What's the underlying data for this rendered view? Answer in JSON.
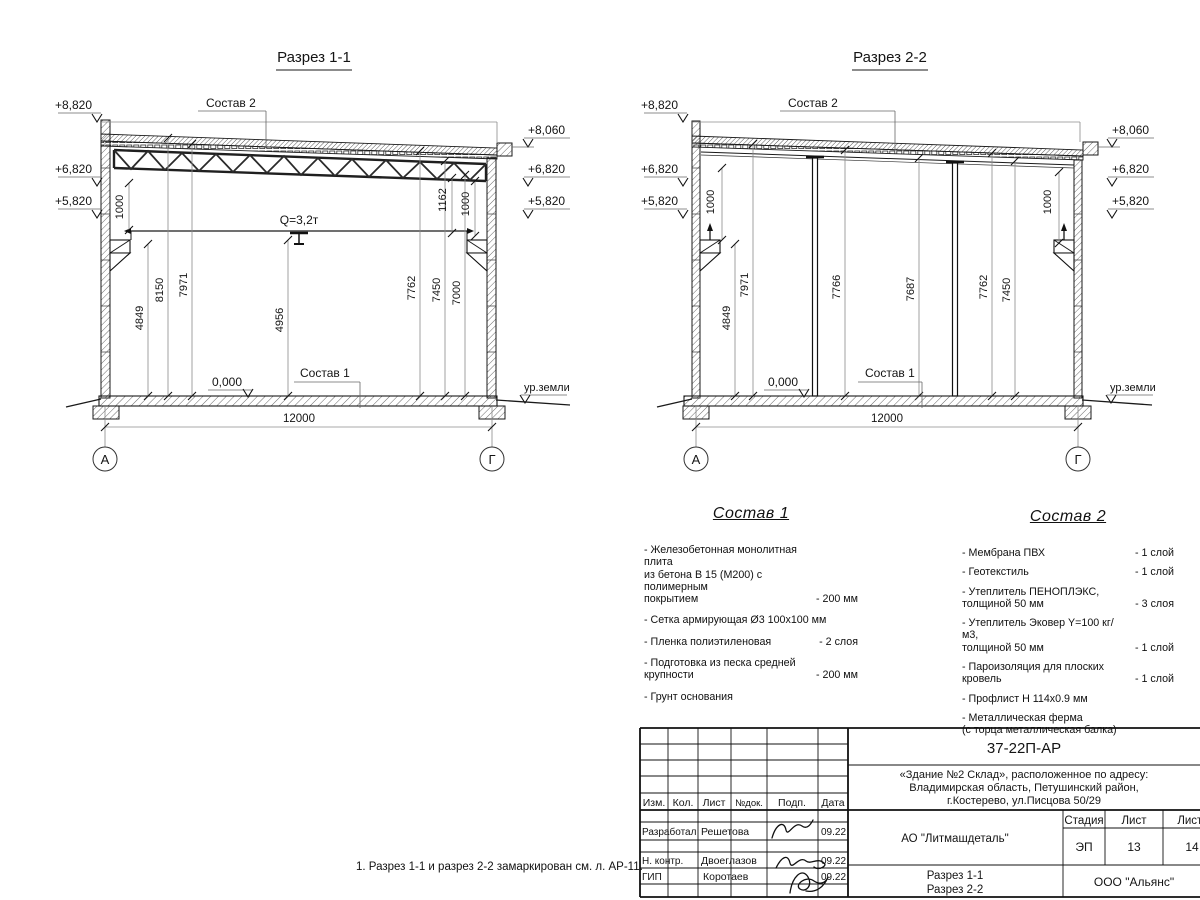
{
  "sheet": {
    "note": "1. Разрез 1-1 и разрез 2-2 замаркирован см. л. АР-11."
  },
  "s1": {
    "title": "Разрез 1-1",
    "e_l1": "+8,820",
    "e_l2": "+6,820",
    "e_l3": "+5,820",
    "e_r1": "+8,060",
    "e_r2": "+6,820",
    "e_r3": "+5,820",
    "roof_callout": "Состав 2",
    "floor_callout": "Состав 1",
    "crane": "Q=3,2т",
    "zero": "0,000",
    "ground": "ур.земли",
    "span": "12000",
    "axA": "А",
    "axG": "Г",
    "d1": "4849",
    "d2": "8150",
    "d3": "7971",
    "d4": "4956",
    "d5": "7762",
    "d6": "7450",
    "d7": "7000",
    "t1": "1000",
    "t2": "1162",
    "t3": "1000"
  },
  "s2": {
    "title": "Разрез 2-2",
    "e_l1": "+8,820",
    "e_l2": "+6,820",
    "e_l3": "+5,820",
    "e_r1": "+8,060",
    "e_r2": "+6,820",
    "e_r3": "+5,820",
    "roof_callout": "Состав 2",
    "floor_callout": "Состав 1",
    "zero": "0,000",
    "ground": "ур.земли",
    "span": "12000",
    "axA": "А",
    "axG": "Г",
    "d1": "4849",
    "d2": "7971",
    "d3": "7766",
    "d4": "7687",
    "d5": "7762",
    "d6": "7450",
    "t1": "1000",
    "t2": "1000"
  },
  "sostav1": {
    "title": "Состав 1",
    "items": [
      {
        "name": "- Железобетонная  монолитная плита\nиз бетона В 15 (М200) с полимерным\nпокрытием",
        "value": "- 200 мм"
      },
      {
        "name": "- Сетка армирующая Ø3 100х100 мм",
        "value": ""
      },
      {
        "name": "- Пленка полиэтиленовая",
        "value": "- 2 слоя"
      },
      {
        "name": "- Подготовка из песка средней\nкрупности",
        "value": "- 200 мм"
      },
      {
        "name": "- Грунт основания",
        "value": ""
      }
    ]
  },
  "sostav2": {
    "title": "Состав 2",
    "items": [
      {
        "name": "- Мембрана ПВХ",
        "value": "- 1 слой"
      },
      {
        "name": "- Геотекстиль",
        "value": "- 1 слой"
      },
      {
        "name": "- Утеплитель ПЕНОПЛЭКС,\nтолщиной 50 мм",
        "value": "- 3 слоя"
      },
      {
        "name": "- Утеплитель Эковер Y=100 кг/м3,\nтолщиной 50 мм",
        "value": "- 1 слой"
      },
      {
        "name": "- Пароизоляция для плоских кровель",
        "value": "- 1 слой"
      },
      {
        "name": "- Профлист Н 114х0.9 мм",
        "value": ""
      },
      {
        "name": "- Металлическая ферма\n(с торца металлическая балка)",
        "value": ""
      }
    ]
  },
  "tb": {
    "doc": "37-22П-АР",
    "addr1": "«Здание №2 Склад», расположенное по адресу:",
    "addr2": "Владимирская область, Петушинский район,",
    "addr3": "г.Костерево, ул.Писцова 50/29",
    "company": "АО \"Литмашдеталь\"",
    "h_stage": "Стадия",
    "h_sheet": "Лист",
    "h_sheets": "Листов",
    "stage": "ЭП",
    "sheet": "13",
    "sheets": "14",
    "content1": "Разрез 1-1",
    "content2": "Разрез 2-2",
    "org": "ООО \"Альянс\"",
    "c_izm": "Изм.",
    "c_kol": "Кол.",
    "c_list": "Лист",
    "c_ndok": "№док.",
    "c_podp": "Подп.",
    "c_data": "Дата",
    "r1_role": "Разработал",
    "r1_name": "Решетова",
    "r1_date": "09.22",
    "r2_role": "Н. контр.",
    "r2_name": "Двоеглазов",
    "r2_date": "09.22",
    "r3_role": "ГИП",
    "r3_name": "Коротаев",
    "r3_date": "09.22"
  }
}
